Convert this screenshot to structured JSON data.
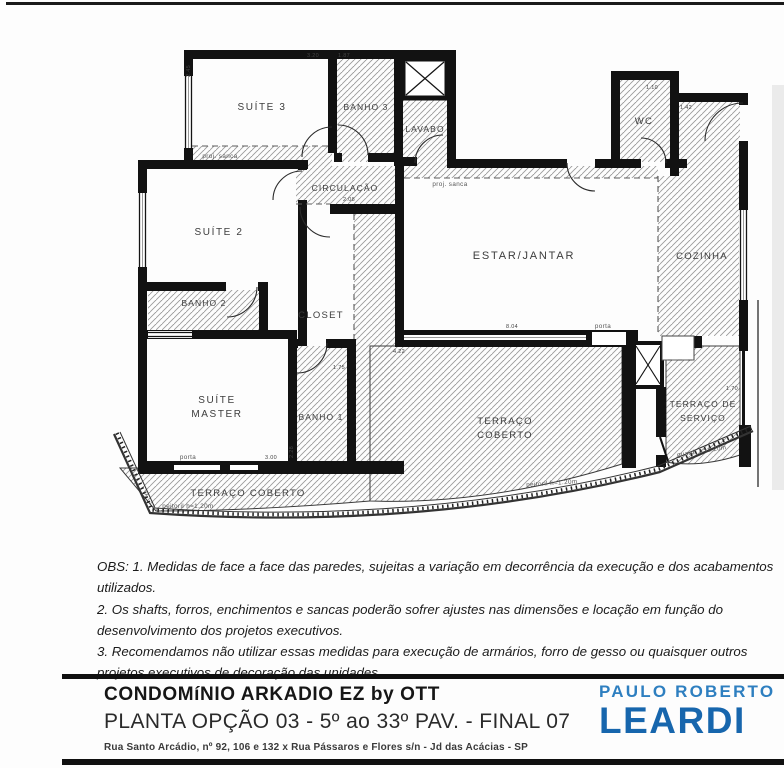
{
  "plan": {
    "rooms": {
      "suite3": "SUÍTE 3",
      "banho3": "BANHO 3",
      "lavabo": "LAVABO",
      "wc": "WC",
      "circulacao": "CIRCULAÇÃO",
      "suite2": "SUÍTE 2",
      "estar": "ESTAR/JANTAR",
      "cozinha": "COZINHA",
      "banho2": "BANHO 2",
      "closet": "CLOSET",
      "suite_master_1": "SUÍTE",
      "suite_master_2": "MASTER",
      "banho1": "BANHO 1",
      "terraco_1": "TERRAÇO",
      "terraco_2": "COBERTO",
      "servico_1": "TERRAÇO DE",
      "servico_2": "SERVIÇO",
      "terraco_strip": "TERRAÇO COBERTO"
    },
    "annotations": {
      "sanca1": "proj. sanca",
      "sanca2": "proj. sanca",
      "porta1": "porta",
      "porta2": "porta",
      "peitoril1": "peitoril h=1.20m",
      "peitoril2": "peitoril h=1.20m",
      "guarda": "guard. h=1.20m",
      "c_mark": "c"
    },
    "dims": {
      "d245": "2.45",
      "d320": "3.20",
      "d187": "1.87",
      "d110": "1.10",
      "d142": "1.42",
      "d804": "8.04",
      "d422": "4.22",
      "d300": "3.00",
      "d208": "2.08",
      "d175": "1.75",
      "d228": "2.28",
      "d170": "1.70"
    }
  },
  "notes": {
    "line1": "OBS: 1. Medidas de face a face das paredes, sujeitas a variação em decorrência da execução e dos acabamentos utilizados.",
    "line2": "2. Os shafts,  forros, enchimentos e sancas poderão sofrer ajustes nas dimensões e locação em função do desenvolvimento dos projetos executivos.",
    "line3": "3. Recomendamos não utilizar essas medidas para execução de armários, forro de gesso ou quaisquer outros projetos executivos de decoração das unidades."
  },
  "footer": {
    "title": "CONDOMíNIO ARKADIO EZ by OTT",
    "subtitle": "PLANTA  OPÇÃO 03 - 5º ao 33º PAV. - FINAL 07",
    "address": "Rua Santo Arcádio, nº 92, 106 e 132 x Rua Pássaros e Flores s/n - Jd das Acácias - SP",
    "logo": {
      "top": "PAULO ROBERTO",
      "name": "LEARDI",
      "color_top": "#2e7fc0",
      "color_name": "#1766ad"
    }
  }
}
